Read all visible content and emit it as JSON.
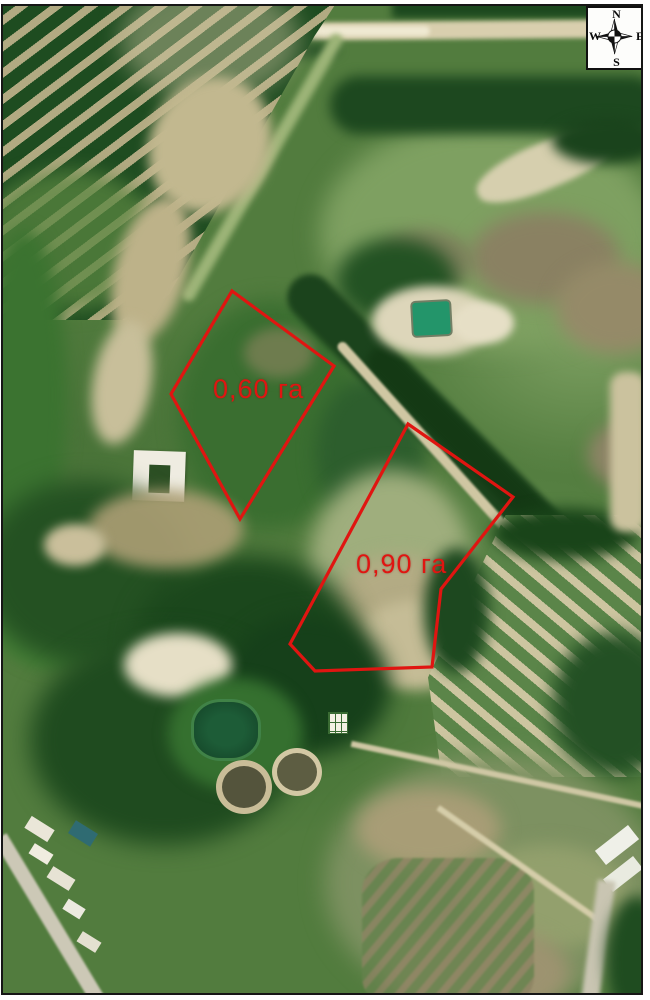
{
  "compass": {
    "north": "N",
    "east": "E",
    "south": "S",
    "west": "W"
  },
  "map": {
    "annotation_color": "#e01511",
    "parcels": [
      {
        "id": "1",
        "label": "0,60 га",
        "area_value": "0,60",
        "area_unit": "га",
        "polygon": [
          [
            232,
            291
          ],
          [
            334,
            366
          ],
          [
            240,
            519
          ],
          [
            171,
            394
          ]
        ],
        "label_pos": [
          213,
          374
        ]
      },
      {
        "id": "2",
        "label": "0,90 га",
        "area_value": "0,90",
        "area_unit": "га",
        "polygon": [
          [
            408,
            424
          ],
          [
            513,
            497
          ],
          [
            441,
            589
          ],
          [
            432,
            667
          ],
          [
            315,
            671
          ],
          [
            290,
            644
          ]
        ],
        "label_pos": [
          356,
          549
        ]
      }
    ]
  }
}
